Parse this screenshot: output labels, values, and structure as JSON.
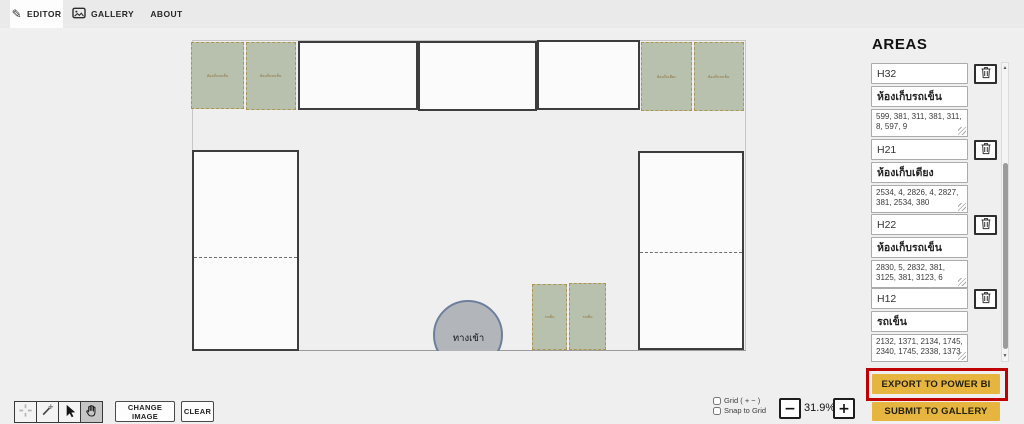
{
  "tabs": {
    "editor": "EDITOR",
    "gallery": "GALLERY",
    "about": "ABOUT"
  },
  "icons": {
    "pencil": "✎",
    "scroll_up": "▲",
    "scroll_down": "▼"
  },
  "canvas": {
    "entrance_label": "ทางเข้า",
    "area_labels": [
      "ห้องเก็บรถเข็น",
      "ห้องเก็บรถเข็น",
      "ห้องเก็บเตียง",
      "ห้องเก็บรถเข็น",
      "รถเข็น",
      "รถเข็น"
    ]
  },
  "areas_panel": {
    "title": "AREAS",
    "items": [
      {
        "id": "H32",
        "name": "ห้องเก็บรถเข็น",
        "coords": "599, 381, 311, 381, 311, 8, 597, 9"
      },
      {
        "id": "H21",
        "name": "ห้องเก็บเตียง",
        "coords": "2534, 4, 2826, 4, 2827, 381, 2534, 380"
      },
      {
        "id": "H22",
        "name": "ห้องเก็บรถเข็น",
        "coords": "2830, 5, 2832, 381, 3125, 381, 3123, 6"
      },
      {
        "id": "H12",
        "name": "รถเข็น",
        "coords": "2132, 1371, 2134, 1745, 2340, 1745, 2338, 1373"
      }
    ]
  },
  "actions": {
    "export_label": "EXPORT TO POWER BI",
    "submit_label": "SUBMIT TO GALLERY",
    "change_image_label": "CHANGE IMAGE",
    "clear_label": "CLEAR"
  },
  "view_controls": {
    "grid_label": "Grid ( + − )",
    "snap_label": "Snap to Grid",
    "zoom_out": "−",
    "zoom_level": "31.9%",
    "zoom_in": "+"
  },
  "colors": {
    "accent_yellow": "#e6b540",
    "highlight_red": "#bf0000",
    "area_green": "#b7c1ad"
  }
}
